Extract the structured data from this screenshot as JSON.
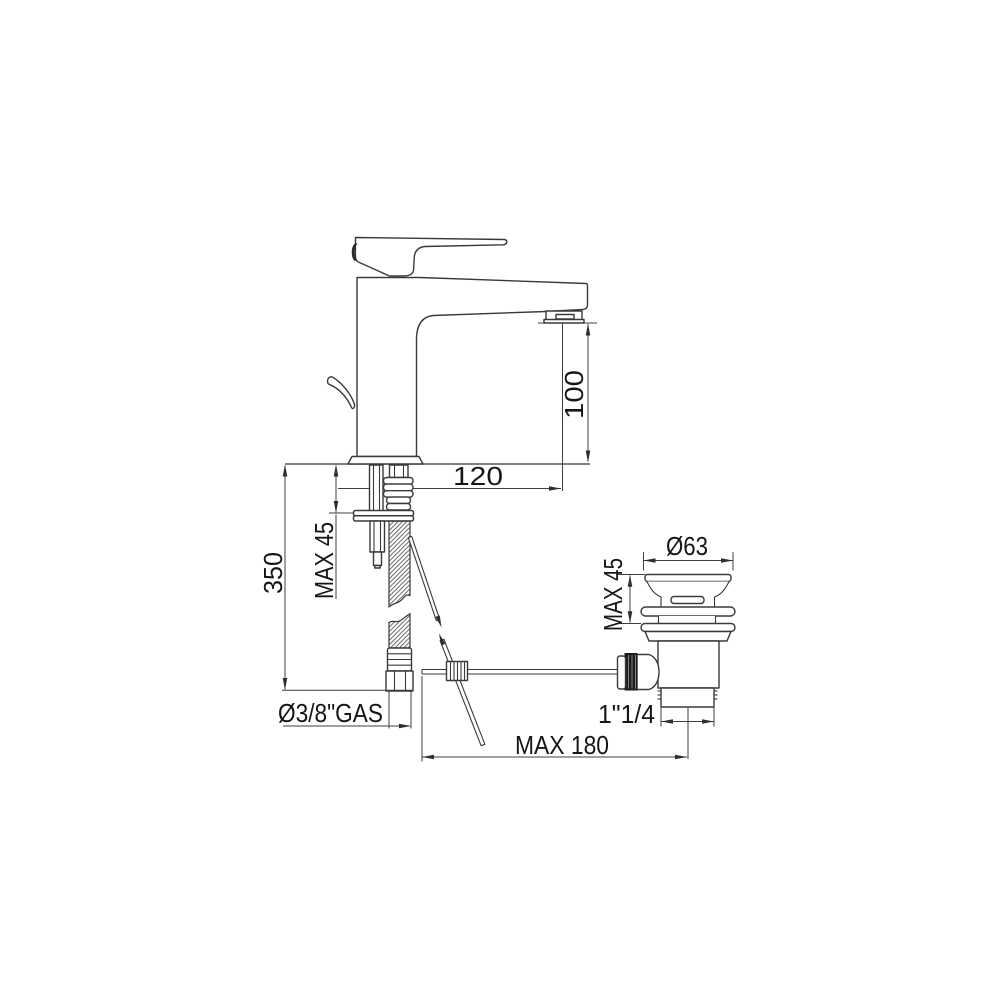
{
  "drawing": {
    "description": "Technical dimensional drawing of a single-lever basin mixer tap with flexible supply hose and pop-up waste drain",
    "background": "#ffffff",
    "colors": {
      "line": "#3a3a3a",
      "dimension_line": "#3f3f3f",
      "text": "#161616",
      "dark_fill": "#1d1d1d"
    }
  },
  "labels": {
    "spout_height": "100",
    "spout_reach": "120",
    "deck_thickness_max": "MAX 45",
    "total_height": "350",
    "supply_connection": "Ø3/8\"GAS",
    "waste_flange_diameter": "Ø63",
    "waste_deck_max": "MAX 45",
    "waste_thread": "1\"1/4",
    "rod_reach_max": "MAX 180"
  }
}
